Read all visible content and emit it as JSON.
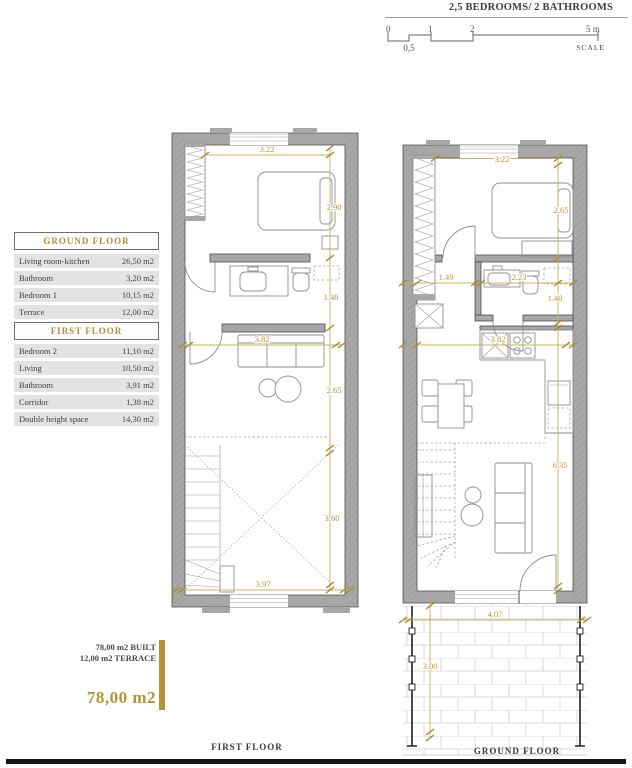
{
  "header": {
    "title": "2,5 BEDROOMS/ 2 BATHROOMS"
  },
  "scale": {
    "tick_0": "0",
    "tick_1": "1",
    "tick_2": "2",
    "tick_5": "5 m",
    "half": "0,5",
    "caption": "SCALE"
  },
  "legend": {
    "ground": {
      "title": "GROUND FLOOR",
      "rows": [
        {
          "label": "Living room-kitchen",
          "value": "26,50 m2"
        },
        {
          "label": "Bathroom",
          "value": "3,20 m2"
        },
        {
          "label": "Bedroom 1",
          "value": "10,15 m2"
        },
        {
          "label": "Terrace",
          "value": "12,00 m2"
        }
      ]
    },
    "first": {
      "title": "FIRST FLOOR",
      "rows": [
        {
          "label": "Bedroom 2",
          "value": "11,10 m2"
        },
        {
          "label": "Living",
          "value": "10,50 m2"
        },
        {
          "label": "Bathroom",
          "value": "3,91 m2"
        },
        {
          "label": "Corridor",
          "value": "1,38 m2"
        },
        {
          "label": "Double height space",
          "value": "14,30 m2"
        }
      ]
    }
  },
  "summary": {
    "built": "78,00 m2 BUILT",
    "terrace": "12,00 m2 TERRACE",
    "total": "78,00 m2"
  },
  "first_floor": {
    "caption": "FIRST FLOOR",
    "dims": {
      "width_top": "3.22",
      "bedroom_depth": "2.90",
      "bathroom_depth": "1.40",
      "living_width": "3.82",
      "living_depth": "2.65",
      "void_depth": "3.60",
      "width_bottom": "3.97"
    }
  },
  "ground_floor": {
    "caption": "GROUND FLOOR",
    "dims": {
      "width_top": "3.22",
      "bedroom_depth": "2.65",
      "corridor_width": "1.49",
      "bathroom_width": "2.23",
      "bathroom_depth": "1.40",
      "kitchen_width": "3.82",
      "living_depth": "6.35",
      "terrace_width": "4.07",
      "terrace_depth": "3.00"
    }
  },
  "colors": {
    "accent_gold": "#b5952f",
    "wall_gray": "#a7a7a7",
    "line_dark": "#4d4d4d"
  }
}
